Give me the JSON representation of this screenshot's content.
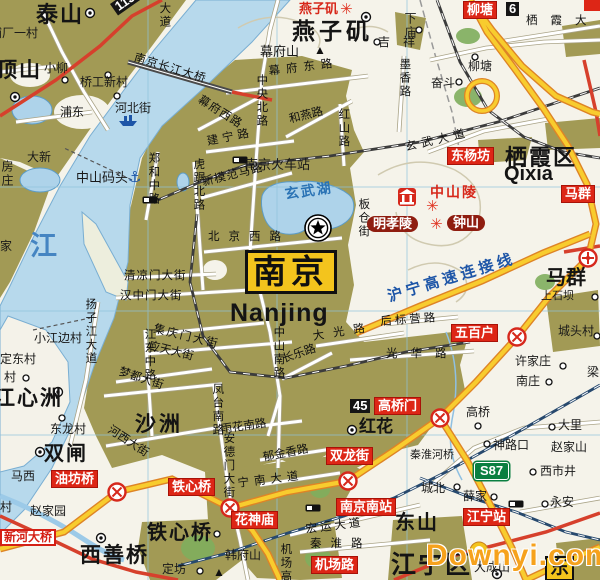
{
  "map": {
    "city": "南京",
    "city_latin": "Nanjing",
    "colors": {
      "urban_area": "#a29a55",
      "water": "#b7d9ec",
      "expressway": "#f8cc2e",
      "expressway_casing": "#de8426",
      "major_road_red": "#d6402c",
      "railway": "#3c3c3c",
      "high_speed_rail": "#27496e",
      "label_red": "#dd2616",
      "label_maroon": "#8f1d10",
      "city_box_yellow": "#f3c41d",
      "watermark_orange": "#f6a21c"
    },
    "icons": {
      "capital-star-icon": "star in double circle",
      "interchange-icon": "red circle with X",
      "junction-target-icon": "red circle with cross and dot",
      "village-dot-icon": "small circle",
      "town-dot-icon": "circle with center dot",
      "railway-station-icon": "black/white rectangle",
      "anchor-icon": "⚓",
      "ship-icon": "small blue ship",
      "scenic-icon": "✳",
      "peak-icon": "▲",
      "shrine-icon": "red square with white mausoleum"
    },
    "labels": [
      {
        "t": "泰山",
        "x": 36,
        "y": 3,
        "c": "town-xl",
        "n": "town-label"
      },
      {
        "t": "浦厂一村",
        "x": -10,
        "y": 27,
        "c": "town-md",
        "n": "town-label"
      },
      {
        "t": "顶山",
        "x": -4,
        "y": 60,
        "c": "town-xl",
        "fs": 21,
        "n": "town-label"
      },
      {
        "t": "小柳",
        "x": 44,
        "y": 62,
        "c": "town-md",
        "n": "town-label"
      },
      {
        "t": "桥工新村",
        "x": 80,
        "y": 76,
        "c": "town-md",
        "n": "town-label"
      },
      {
        "t": "浦东",
        "x": 60,
        "y": 106,
        "c": "town-md",
        "n": "town-label"
      },
      {
        "t": "河北街",
        "x": 115,
        "y": 102,
        "c": "town-md",
        "n": "town-label"
      },
      {
        "t": "大新",
        "x": 27,
        "y": 151,
        "c": "town-md",
        "n": "town-label"
      },
      {
        "t": "房庄",
        "x": 0,
        "y": 160,
        "c": "town-md",
        "v": 1,
        "n": "town-label"
      },
      {
        "t": "家",
        "x": 0,
        "y": 240,
        "c": "town-md",
        "n": "town-label"
      },
      {
        "t": "中山码头",
        "x": 76,
        "y": 171,
        "c": "town-md",
        "fs": 13,
        "n": "poi-label"
      },
      {
        "t": "⚓",
        "x": 128,
        "y": 170,
        "c": "anchor",
        "n": "anchor-icon"
      },
      {
        "t": "江",
        "x": 30,
        "y": 232,
        "c": "river-big",
        "n": "water-label"
      },
      {
        "t": "南京长江大桥",
        "x": 136,
        "y": 52,
        "c": "road",
        "r": 17,
        "ls": 1,
        "n": "bridge-label"
      },
      {
        "t": "大道",
        "x": 158,
        "y": 2,
        "c": "road",
        "v": 1,
        "n": "road-label"
      },
      {
        "t": "113",
        "x": 110,
        "y": 4,
        "c": "shield",
        "r": -35,
        "n": "route-shield"
      },
      {
        "t": "燕子矶",
        "x": 299,
        "y": 2,
        "c": "red-text",
        "n": "scenic-label"
      },
      {
        "t": "✳",
        "x": 340,
        "y": 2,
        "c": "scenic",
        "n": "scenic-icon"
      },
      {
        "t": "燕子矶",
        "x": 292,
        "y": 19,
        "c": "town-xl",
        "fs": 23,
        "ls": 4,
        "n": "town-label"
      },
      {
        "t": "幕府山",
        "x": 260,
        "y": 45,
        "c": "town-md",
        "fs": 13,
        "n": "mountain-label"
      },
      {
        "t": "▲",
        "x": 314,
        "y": 44,
        "c": "peak",
        "n": "peak-icon"
      },
      {
        "t": "吉祥",
        "x": 378,
        "y": 36,
        "c": "town-md",
        "ls": 13,
        "n": "town-label"
      },
      {
        "t": "下庙",
        "x": 403,
        "y": 12,
        "c": "town-md",
        "v": 1,
        "n": "town-label"
      },
      {
        "t": "柳塘",
        "x": 464,
        "y": 2,
        "c": "red-box",
        "n": "interchange-label"
      },
      {
        "t": "6",
        "x": 506,
        "y": 2,
        "c": "shield",
        "n": "route-shield"
      },
      {
        "t": "栖霞大道",
        "x": 526,
        "y": 15,
        "c": "road",
        "ls": 13,
        "n": "road-label"
      },
      {
        "t": "幕府东路",
        "x": 268,
        "y": 66,
        "c": "road",
        "r": -7,
        "ls": 6,
        "n": "road-label"
      },
      {
        "t": "幕府西路",
        "x": 202,
        "y": 94,
        "c": "road",
        "r": 32,
        "ls": 1,
        "n": "road-label"
      },
      {
        "t": "中央北路",
        "x": 255,
        "y": 74,
        "c": "road",
        "v": 1,
        "n": "road-label"
      },
      {
        "t": "和燕路",
        "x": 288,
        "y": 114,
        "c": "road",
        "r": -14,
        "n": "road-label"
      },
      {
        "t": "红山路",
        "x": 337,
        "y": 108,
        "c": "road",
        "v": 1,
        "n": "road-label"
      },
      {
        "t": "墨香路",
        "x": 398,
        "y": 58,
        "c": "road",
        "v": 1,
        "n": "road-label"
      },
      {
        "t": "玄武大道",
        "x": 404,
        "y": 142,
        "c": "road",
        "r": -13,
        "ls": 5,
        "n": "road-label"
      },
      {
        "t": "柳塘",
        "x": 468,
        "y": 60,
        "c": "town-md",
        "n": "town-label"
      },
      {
        "t": "奋斗",
        "x": 431,
        "y": 77,
        "c": "town-md",
        "n": "town-label"
      },
      {
        "t": "建宁路",
        "x": 206,
        "y": 136,
        "c": "road",
        "r": -11,
        "ls": 4,
        "n": "road-label"
      },
      {
        "t": "南京火车站",
        "x": 245,
        "y": 158,
        "c": "town-md",
        "fs": 13,
        "n": "station-label"
      },
      {
        "t": "新模范马路",
        "x": 201,
        "y": 177,
        "c": "road",
        "r": -14,
        "ls": 1,
        "n": "road-label"
      },
      {
        "t": "郑和中路",
        "x": 147,
        "y": 152,
        "c": "road",
        "v": 1,
        "n": "road-label"
      },
      {
        "t": "虎踞北路",
        "x": 192,
        "y": 158,
        "c": "road",
        "v": 1,
        "n": "road-label"
      },
      {
        "t": "玄武湖",
        "x": 284,
        "y": 187,
        "c": "water-name",
        "r": -8,
        "n": "water-label"
      },
      {
        "t": "板仓街",
        "x": 357,
        "y": 198,
        "c": "road",
        "v": 1,
        "n": "road-label"
      },
      {
        "t": "东杨坊",
        "x": 448,
        "y": 148,
        "c": "red-box",
        "n": "interchange-label"
      },
      {
        "t": "栖霞区",
        "x": 505,
        "y": 146,
        "c": "town-xl",
        "fs": 22,
        "ls": 2,
        "n": "district-label"
      },
      {
        "t": "Qixia",
        "x": 504,
        "y": 164,
        "c": "latin-md",
        "n": "district-label-latin"
      },
      {
        "t": "马群",
        "x": 562,
        "y": 186,
        "c": "red-box",
        "n": "interchange-label"
      },
      {
        "t": "中山陵",
        "x": 430,
        "y": 185,
        "c": "red-text",
        "fs": 14,
        "ls": 2,
        "n": "scenic-label"
      },
      {
        "t": "✳",
        "x": 426,
        "y": 199,
        "c": "scenic",
        "n": "scenic-icon"
      },
      {
        "t": "明孝陵",
        "x": 367,
        "y": 216,
        "c": "maroon",
        "n": "scenic-label"
      },
      {
        "t": "✳",
        "x": 430,
        "y": 217,
        "c": "scenic",
        "n": "scenic-icon"
      },
      {
        "t": "钟山",
        "x": 447,
        "y": 215,
        "c": "maroon",
        "n": "scenic-label"
      },
      {
        "t": "北京西路",
        "x": 208,
        "y": 231,
        "c": "road",
        "ls": 9,
        "n": "road-label"
      },
      {
        "t": "南京",
        "x": 245,
        "y": 250,
        "c": "nanjing-box",
        "n": "city-label"
      },
      {
        "t": "Nanjing",
        "x": 230,
        "y": 300,
        "c": "latin-big",
        "n": "city-label-latin"
      },
      {
        "t": "沪宁高速连接线",
        "x": 386,
        "y": 290,
        "c": "blue-road",
        "r": -17,
        "ls": 4,
        "n": "expressway-label"
      },
      {
        "t": "马群",
        "x": 546,
        "y": 268,
        "c": "town-lg",
        "fs": 20,
        "n": "town-label"
      },
      {
        "t": "上石坝",
        "x": 541,
        "y": 291,
        "c": "town-md",
        "fs": 11,
        "n": "town-label"
      },
      {
        "t": "清凉门大街",
        "x": 124,
        "y": 270,
        "c": "road",
        "ls": 1,
        "n": "road-label"
      },
      {
        "t": "汉中门大街",
        "x": 120,
        "y": 290,
        "c": "road",
        "ls": 1,
        "n": "road-label"
      },
      {
        "t": "集庆门大街",
        "x": 155,
        "y": 323,
        "c": "road",
        "r": 14,
        "ls": 2,
        "n": "road-label"
      },
      {
        "t": "应天大街",
        "x": 150,
        "y": 340,
        "c": "road",
        "r": 14,
        "n": "road-label"
      },
      {
        "t": "小江边村",
        "x": 34,
        "y": 332,
        "c": "town-md",
        "n": "town-label"
      },
      {
        "t": "定东村",
        "x": 0,
        "y": 353,
        "c": "town-md",
        "n": "town-label"
      },
      {
        "t": "村",
        "x": 4,
        "y": 371,
        "c": "town-md",
        "n": "town-label"
      },
      {
        "t": "扬子江大道",
        "x": 84,
        "y": 298,
        "c": "road",
        "v": 1,
        "n": "road-label"
      },
      {
        "t": "江东中路",
        "x": 143,
        "y": 328,
        "c": "road",
        "v": 1,
        "n": "road-label"
      },
      {
        "t": "梦都大街",
        "x": 121,
        "y": 366,
        "c": "road",
        "r": 18,
        "n": "road-label"
      },
      {
        "t": "江心洲",
        "x": -6,
        "y": 388,
        "c": "town-xl",
        "fs": 21,
        "n": "town-label"
      },
      {
        "t": "东龙村",
        "x": 50,
        "y": 423,
        "c": "town-md",
        "n": "town-label"
      },
      {
        "t": "沙洲",
        "x": 135,
        "y": 414,
        "c": "town-xl",
        "fs": 21,
        "ls": 3,
        "n": "town-label"
      },
      {
        "t": "河西大街",
        "x": 112,
        "y": 424,
        "c": "road",
        "r": 33,
        "n": "road-label"
      },
      {
        "t": "后标营路",
        "x": 380,
        "y": 316,
        "c": "road",
        "r": -4,
        "ls": 3,
        "n": "road-label"
      },
      {
        "t": "光华路",
        "x": 386,
        "y": 348,
        "c": "road",
        "ls": 13,
        "n": "road-label"
      },
      {
        "t": "大光路",
        "x": 312,
        "y": 331,
        "c": "road",
        "r": -9,
        "ls": 9,
        "n": "road-label"
      },
      {
        "t": "长乐路",
        "x": 281,
        "y": 354,
        "c": "road",
        "r": -19,
        "n": "road-label"
      },
      {
        "t": "中山南路",
        "x": 272,
        "y": 326,
        "c": "road",
        "v": 1,
        "n": "road-label"
      },
      {
        "t": "五百户",
        "x": 452,
        "y": 325,
        "c": "red-box",
        "n": "interchange-label"
      },
      {
        "t": "许家庄",
        "x": 515,
        "y": 355,
        "c": "town-md",
        "n": "town-label"
      },
      {
        "t": "南庄",
        "x": 516,
        "y": 375,
        "c": "town-md",
        "n": "town-label"
      },
      {
        "t": "城头村",
        "x": 558,
        "y": 325,
        "c": "town-md",
        "n": "town-label"
      },
      {
        "t": "梁",
        "x": 587,
        "y": 366,
        "c": "town-md",
        "n": "town-label"
      },
      {
        "t": "大里",
        "x": 558,
        "y": 419,
        "c": "town-md",
        "n": "town-label"
      },
      {
        "t": "高桥",
        "x": 466,
        "y": 406,
        "c": "town-md",
        "n": "town-label"
      },
      {
        "t": "45",
        "x": 350,
        "y": 399,
        "c": "shield",
        "n": "route-shield"
      },
      {
        "t": "高桥门",
        "x": 375,
        "y": 398,
        "c": "red-box",
        "n": "interchange-label"
      },
      {
        "t": "红花",
        "x": 359,
        "y": 418,
        "c": "town-lg",
        "fs": 17,
        "n": "town-label"
      },
      {
        "t": "神路口",
        "x": 493,
        "y": 439,
        "c": "town-md",
        "n": "town-label"
      },
      {
        "t": "赵家山",
        "x": 551,
        "y": 441,
        "c": "town-md",
        "n": "town-label"
      },
      {
        "t": "秦淮河桥",
        "x": 410,
        "y": 450,
        "c": "town-md",
        "fs": 11,
        "n": "bridge-label"
      },
      {
        "t": "S87",
        "x": 474,
        "y": 462,
        "c": "shield-green",
        "n": "route-shield"
      },
      {
        "t": "西市井",
        "x": 540,
        "y": 465,
        "c": "town-md",
        "n": "town-label"
      },
      {
        "t": "城北",
        "x": 421,
        "y": 482,
        "c": "town-md",
        "n": "town-label"
      },
      {
        "t": "薛家",
        "x": 463,
        "y": 490,
        "c": "town-md",
        "n": "town-label"
      },
      {
        "t": "永安",
        "x": 550,
        "y": 496,
        "c": "town-md",
        "n": "town-label"
      },
      {
        "t": "双龙街",
        "x": 327,
        "y": 448,
        "c": "red-box",
        "n": "interchange-label"
      },
      {
        "t": "凤台南路",
        "x": 211,
        "y": 383,
        "c": "road",
        "v": 1,
        "n": "road-label"
      },
      {
        "t": "雨花南路",
        "x": 220,
        "y": 424,
        "c": "road",
        "r": -8,
        "n": "road-label"
      },
      {
        "t": "安德门大街",
        "x": 222,
        "y": 432,
        "c": "road",
        "v": 1,
        "n": "road-label"
      },
      {
        "t": "郁金香路",
        "x": 262,
        "y": 452,
        "c": "road",
        "r": -11,
        "n": "road-label"
      },
      {
        "t": "宁南大道",
        "x": 237,
        "y": 478,
        "c": "road",
        "r": -7,
        "ls": 5,
        "n": "road-label"
      },
      {
        "t": "油坊桥",
        "x": 52,
        "y": 471,
        "c": "red-box",
        "n": "interchange-label"
      },
      {
        "t": "铁心桥",
        "x": 169,
        "y": 479,
        "c": "red-box",
        "n": "interchange-label"
      },
      {
        "t": "花神庙",
        "x": 232,
        "y": 512,
        "c": "red-box",
        "n": "interchange-label"
      },
      {
        "t": "双闸",
        "x": 44,
        "y": 444,
        "c": "town-xl",
        "fs": 20,
        "ls": 2,
        "n": "town-label"
      },
      {
        "t": "马西",
        "x": 11,
        "y": 470,
        "c": "town-md",
        "n": "town-label"
      },
      {
        "t": "村",
        "x": 0,
        "y": 501,
        "c": "town-md",
        "n": "town-label"
      },
      {
        "t": "赵家园",
        "x": 30,
        "y": 505,
        "c": "town-md",
        "n": "town-label"
      },
      {
        "t": "新河大桥",
        "x": 0,
        "y": 529,
        "c": "red-banner",
        "n": "bridge-label"
      },
      {
        "t": "西善桥",
        "x": 80,
        "y": 545,
        "c": "town-xl",
        "fs": 21,
        "ls": 2,
        "n": "town-label"
      },
      {
        "t": "铁心桥",
        "x": 147,
        "y": 523,
        "c": "town-xl",
        "fs": 20,
        "ls": 2,
        "n": "town-label"
      },
      {
        "t": "定坊",
        "x": 162,
        "y": 563,
        "c": "town-md",
        "n": "town-label"
      },
      {
        "t": "韩府山",
        "x": 225,
        "y": 549,
        "c": "town-md",
        "n": "mountain-label"
      },
      {
        "t": "▲",
        "x": 213,
        "y": 566,
        "c": "peak",
        "n": "peak-icon"
      },
      {
        "t": "机场高速",
        "x": 279,
        "y": 543,
        "c": "road",
        "v": 1,
        "n": "road-label"
      },
      {
        "t": "南京南站",
        "x": 337,
        "y": 499,
        "c": "red-box",
        "n": "station-label"
      },
      {
        "t": "宏运大道",
        "x": 305,
        "y": 524,
        "c": "road",
        "r": -7,
        "ls": 3,
        "n": "road-label"
      },
      {
        "t": "秦淮路",
        "x": 310,
        "y": 538,
        "c": "road",
        "ls": 9,
        "n": "road-label"
      },
      {
        "t": "机场路",
        "x": 312,
        "y": 557,
        "c": "red-box",
        "n": "interchange-label"
      },
      {
        "t": "东山",
        "x": 395,
        "y": 513,
        "c": "town-lg",
        "fs": 20,
        "ls": 2,
        "n": "town-label"
      },
      {
        "t": "江宁站",
        "x": 464,
        "y": 509,
        "c": "red-box",
        "n": "station-label"
      },
      {
        "t": "江宁区",
        "x": 391,
        "y": 552,
        "c": "town-xl",
        "fs": 25,
        "ls": 2,
        "n": "district-label"
      },
      {
        "t": "大成山",
        "x": 474,
        "y": 561,
        "c": "town-md",
        "n": "town-label"
      },
      {
        "t": "东",
        "x": 545,
        "y": 556,
        "c": "yellow-box",
        "n": "town-label"
      },
      {
        "t": "Downyi.com",
        "x": 426,
        "y": 540,
        "c": "watermark",
        "n": "watermark"
      }
    ]
  }
}
